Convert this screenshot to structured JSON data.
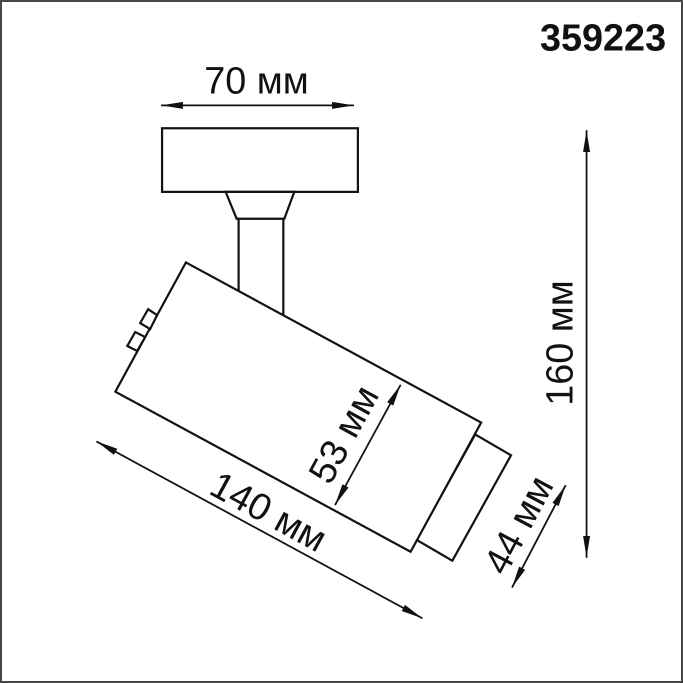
{
  "product_code": "359223",
  "dimension_labels": {
    "plate_width": "70 мм",
    "overall_height": "160 мм",
    "body_diameter": "53 мм",
    "body_length": "140 мм",
    "head_diameter": "44 мм"
  },
  "colors": {
    "line": "#111111",
    "background": "#ffffff",
    "frame_border": "#474747"
  }
}
